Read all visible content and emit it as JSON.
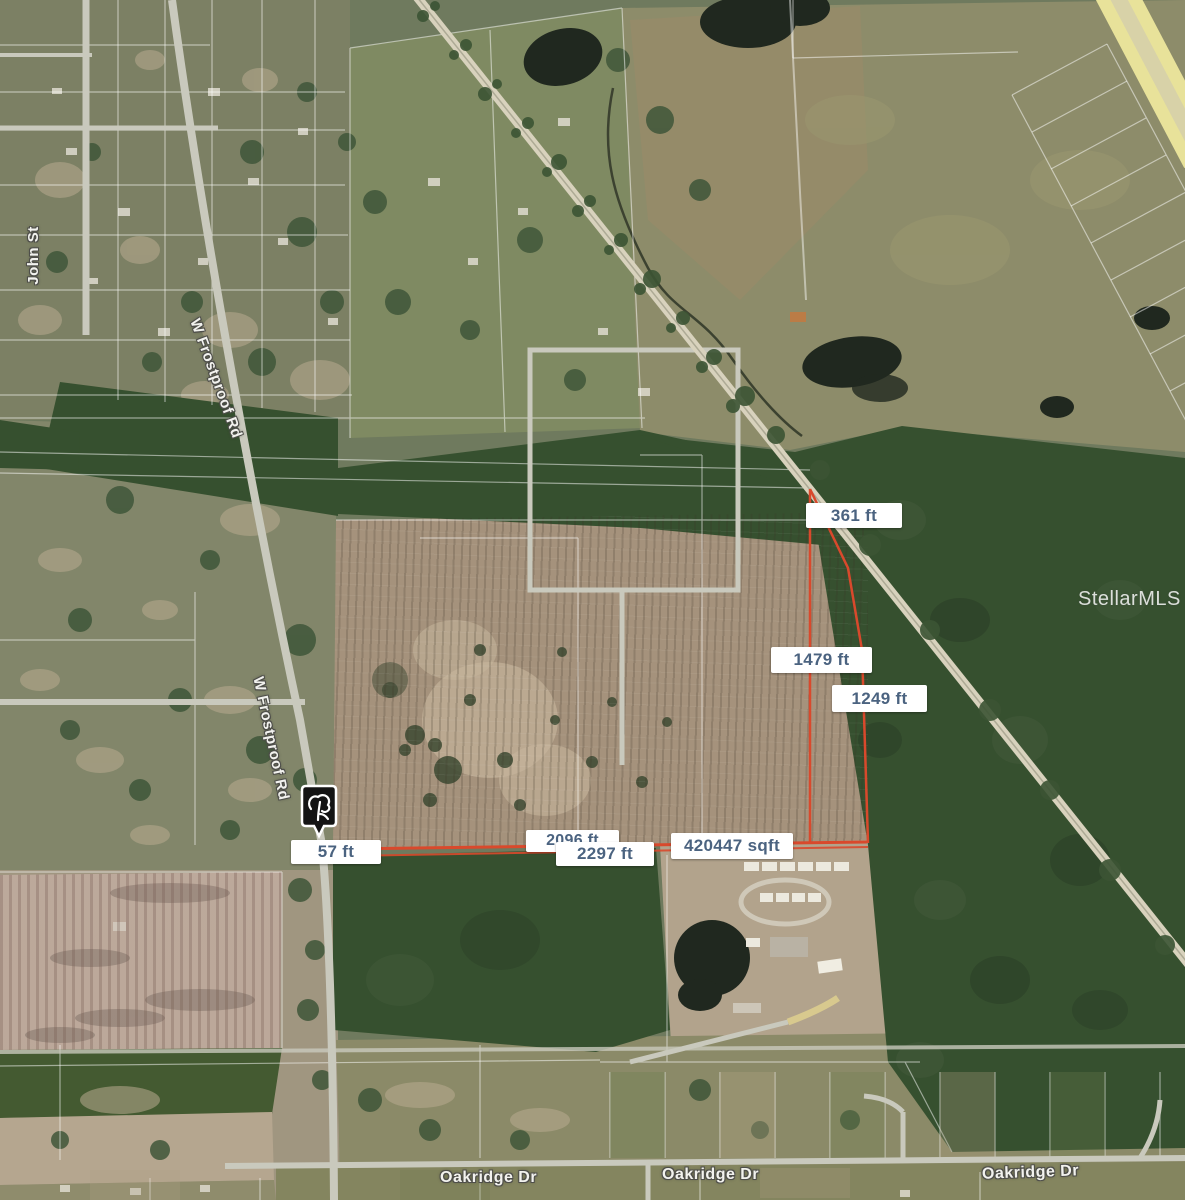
{
  "map": {
    "watermark": "StellarMLS",
    "marker": {
      "icon": "tree-marker-icon"
    },
    "measurements": {
      "seg_361": "361 ft",
      "seg_1479": "1479 ft",
      "seg_1249": "1249 ft",
      "seg_2096": "2096 ft",
      "seg_2297": "2297 ft",
      "area": "420447 sqft",
      "seg_57": "57 ft"
    },
    "roads": {
      "john_st": "John St",
      "frostproof_1": "W Frostproof Rd",
      "frostproof_2": "W Frostproof Rd",
      "oakridge_1": "Oakridge Dr",
      "oakridge_2": "Oakridge Dr",
      "oakridge_3": "Oakridge Dr"
    },
    "colors": {
      "parcel_line": "#d9492c",
      "label_text": "#4b6380",
      "label_bg": "#ffffff"
    }
  }
}
